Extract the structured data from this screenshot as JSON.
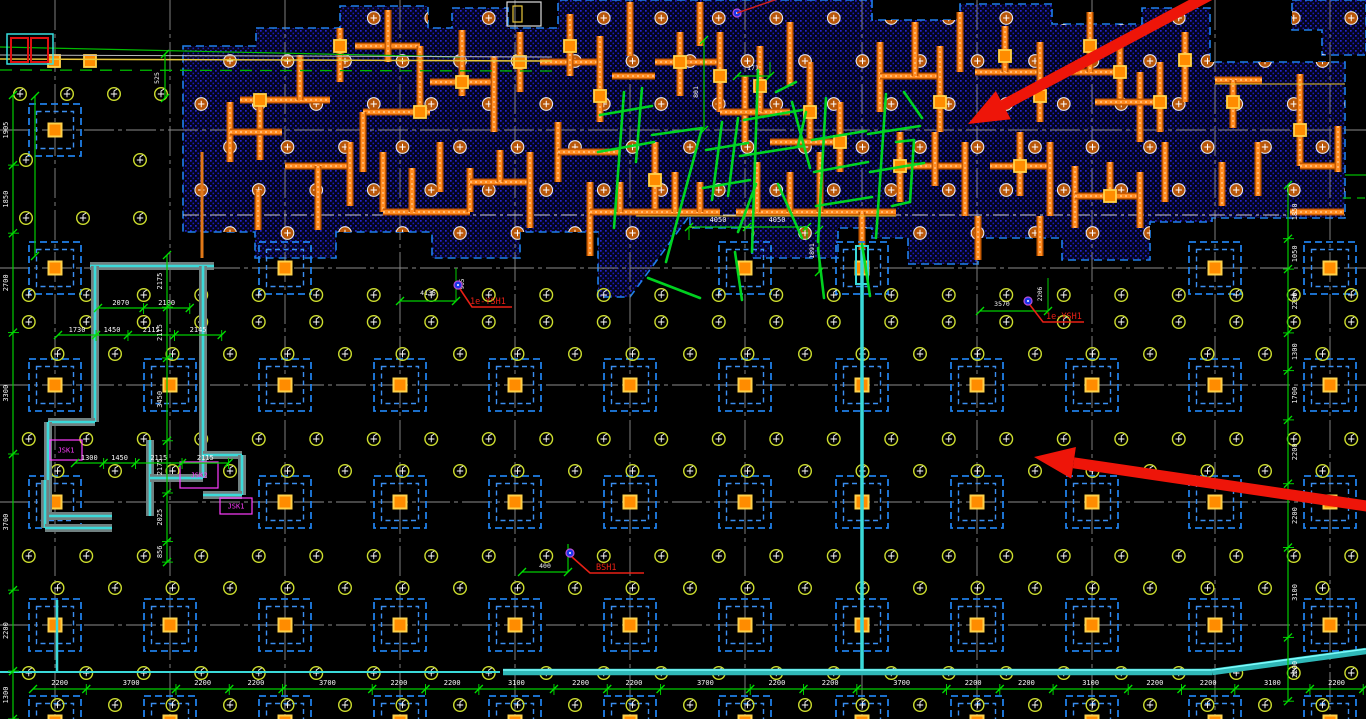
{
  "annotations": {
    "sketch_text": "7#楼结构",
    "leaders": [
      {
        "label": "1e-YSH1"
      },
      {
        "label": "1e-YSH1"
      },
      {
        "label": "BSH1"
      }
    ],
    "room_labels": [
      "JSK1",
      "JSK2",
      "JSK1"
    ]
  },
  "dimensions": {
    "bottom": [
      "2200",
      "3700",
      "2200",
      "2200",
      "3700",
      "2200",
      "2200",
      "3100",
      "2200",
      "2200",
      "3700",
      "2200",
      "2200",
      "3700",
      "2200",
      "2200",
      "3100",
      "2200",
      "2200",
      "3100",
      "2200"
    ],
    "left": [
      "1905",
      "1850",
      "2700",
      "3300",
      "3700",
      "2200",
      "1300"
    ],
    "right": [
      "1850",
      "1050",
      "2200",
      "1300",
      "1700",
      "2200",
      "2200",
      "3100",
      "2200"
    ],
    "interior": {
      "span_a1": "4050",
      "span_a2": "4050",
      "vert_a": "1891",
      "dim_c": "4136",
      "dim_c2": "905",
      "dim_d": "3570",
      "dim_d2": "2206",
      "top_v": "801",
      "top_h": "171",
      "tl_v": "525",
      "near_bsh": "400",
      "stair_row_a": [
        "1730",
        "1450",
        "2115",
        "2145"
      ],
      "stair_row_b": [
        "1300",
        "1450",
        "2115",
        "2115"
      ],
      "stair_row_c": [
        "2070",
        "2100"
      ],
      "stair_col": [
        "2175",
        "2115",
        "3450",
        "2175",
        "2025",
        "856"
      ]
    }
  },
  "colors": {
    "background": "#000000",
    "stipple_blue": "#2323cf",
    "wall_orange": "#ff8a1e",
    "wall_dark": "#c05500",
    "cap_blue": "#1f7fe8",
    "column_orange": "#ff8c00",
    "column_yellow": "#ffd24a",
    "dim_green": "#00cc00",
    "pile_yellowgreen": "#cddd2e",
    "utility_cyan": "#3adada",
    "annotation_red": "#e82015",
    "label_magenta": "#ff3cff",
    "sketch_green": "#00dd22",
    "grid_gray": "#8c8c8c",
    "dim_text": "#f5f5f5"
  }
}
